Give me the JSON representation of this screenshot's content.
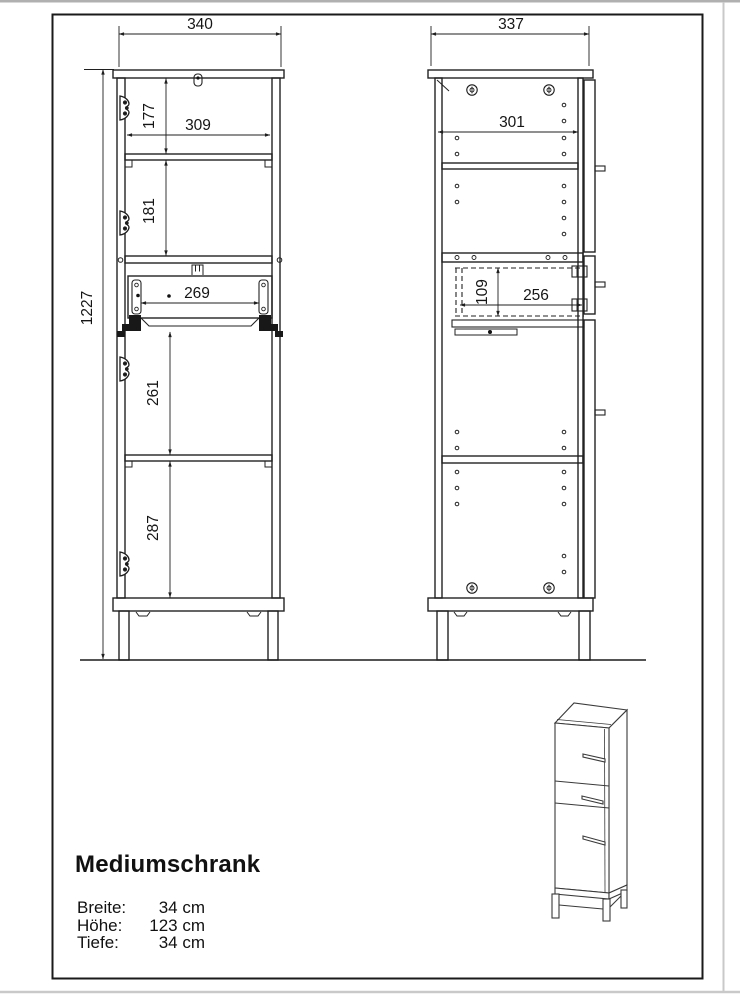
{
  "page": {
    "background": "#ffffff",
    "line_color": "#222222",
    "border_color": "#1a1a1a",
    "edge_shadow_color": "#c9c9c9"
  },
  "front_view": {
    "dims": {
      "overall_width": "340",
      "overall_height": "1227",
      "inner_width": "309",
      "top_height": "177",
      "shelf_height": "181",
      "drawer_width": "269",
      "middle_height": "261",
      "bottom_height": "287"
    }
  },
  "side_view": {
    "dims": {
      "overall_depth": "337",
      "inner_depth": "301",
      "drawer_height": "109",
      "drawer_depth": "256"
    }
  },
  "icons": {
    "hinge": "hinge-icon",
    "screw": "screw-icon",
    "wall_mount": "wall-mount-keyhole-icon",
    "knob": "knob-icon"
  },
  "info": {
    "title": "Mediumschrank",
    "specs": [
      {
        "label": "Breite:",
        "value": "34 cm"
      },
      {
        "label": "Höhe:",
        "value": "123 cm"
      },
      {
        "label": "Tiefe:",
        "value": "34 cm"
      }
    ]
  }
}
